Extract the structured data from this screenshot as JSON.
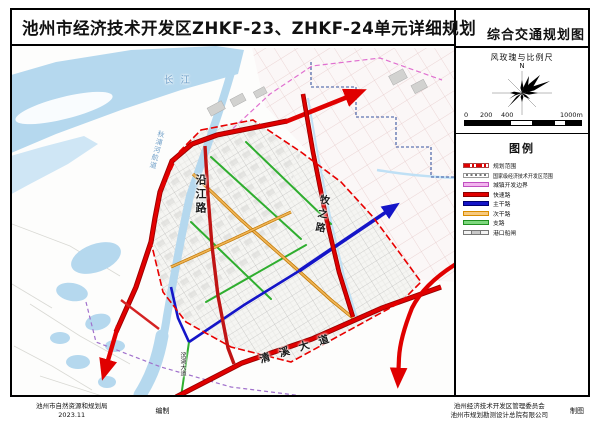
{
  "title": {
    "main": "池州市经济技术开发区ZHKF-23、ZHKF-24单元详细规划",
    "sheet": "综合交通规划图"
  },
  "sidebar": {
    "windrose_title": "风玫瑰与比例尺",
    "north_label": "N",
    "scale_labels": [
      "0",
      "200",
      "400",
      "1000m"
    ],
    "legend_title": "图例",
    "legend_items": [
      {
        "label": "规划范围",
        "type": "dash-red",
        "color": "#e00000",
        "border": "#aa4444"
      },
      {
        "label": "国家级经济技术开发区范围",
        "type": "dot-gray",
        "color": "#777777",
        "border": "#999999"
      },
      {
        "label": "城镇开发边界",
        "type": "band",
        "color": "#f2b4ee",
        "border": "#c050c0"
      },
      {
        "label": "快速路",
        "type": "band",
        "color": "#e00000",
        "border": "#8c0000"
      },
      {
        "label": "主干路",
        "type": "band",
        "color": "#1515c8",
        "border": "#000070"
      },
      {
        "label": "次干路",
        "type": "band",
        "color": "#f7c97e",
        "border": "#d98c00"
      },
      {
        "label": "支路",
        "type": "band",
        "color": "#7ed87e",
        "border": "#209020"
      },
      {
        "label": "港口船闸",
        "type": "gate",
        "color": "#c8c8c8",
        "border": "#777777"
      }
    ]
  },
  "map": {
    "labels": {
      "river": "长江",
      "channel": "秋浦河航道",
      "yanjiang": "沿江路",
      "muzhi": "牧之路",
      "qingxi": "清溪大道",
      "binhu": "滨湖大道"
    }
  },
  "footer": {
    "left_org": "池州市自然资源和规划局",
    "left_date": "2023.11",
    "left_role": "编制",
    "right_org1": "池州经济技术开发区管理委员会",
    "right_org2": "池州市规划勘测设计总院有限公司",
    "right_role": "制图"
  }
}
